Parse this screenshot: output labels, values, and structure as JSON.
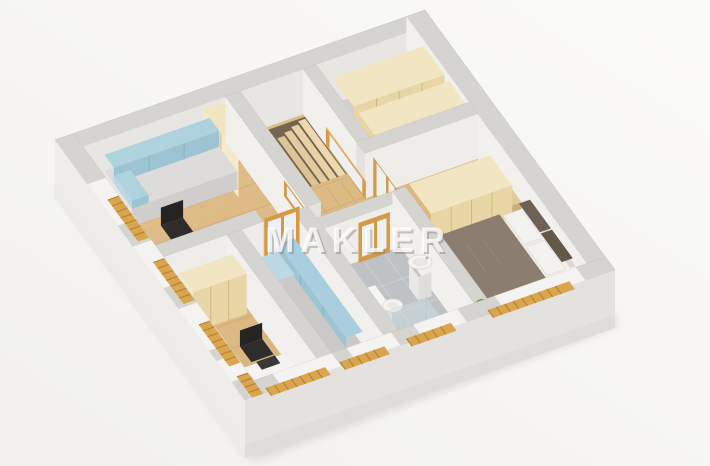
{
  "watermark": {
    "text": "MAKLER",
    "fill": "rgba(255,255,255,0.78)",
    "shadow_fill": "rgba(128,123,117,0.42)"
  },
  "palette": {
    "background": "#f7f6f4",
    "wood_floor": "#dcb983",
    "wall_top": "#d6d4d1",
    "wall_face": "#efedea",
    "tile_gray": "#bfc2c4",
    "wardrobe_wood": "#eadbb0",
    "accent_blue": "#a9cedd",
    "bed_taupe": "#8b7e70",
    "radiator_orange": "#d9a54e",
    "door_wood": "#d59a48",
    "stair_wood": "#d9c08c",
    "plant_green": "#5ea340"
  }
}
